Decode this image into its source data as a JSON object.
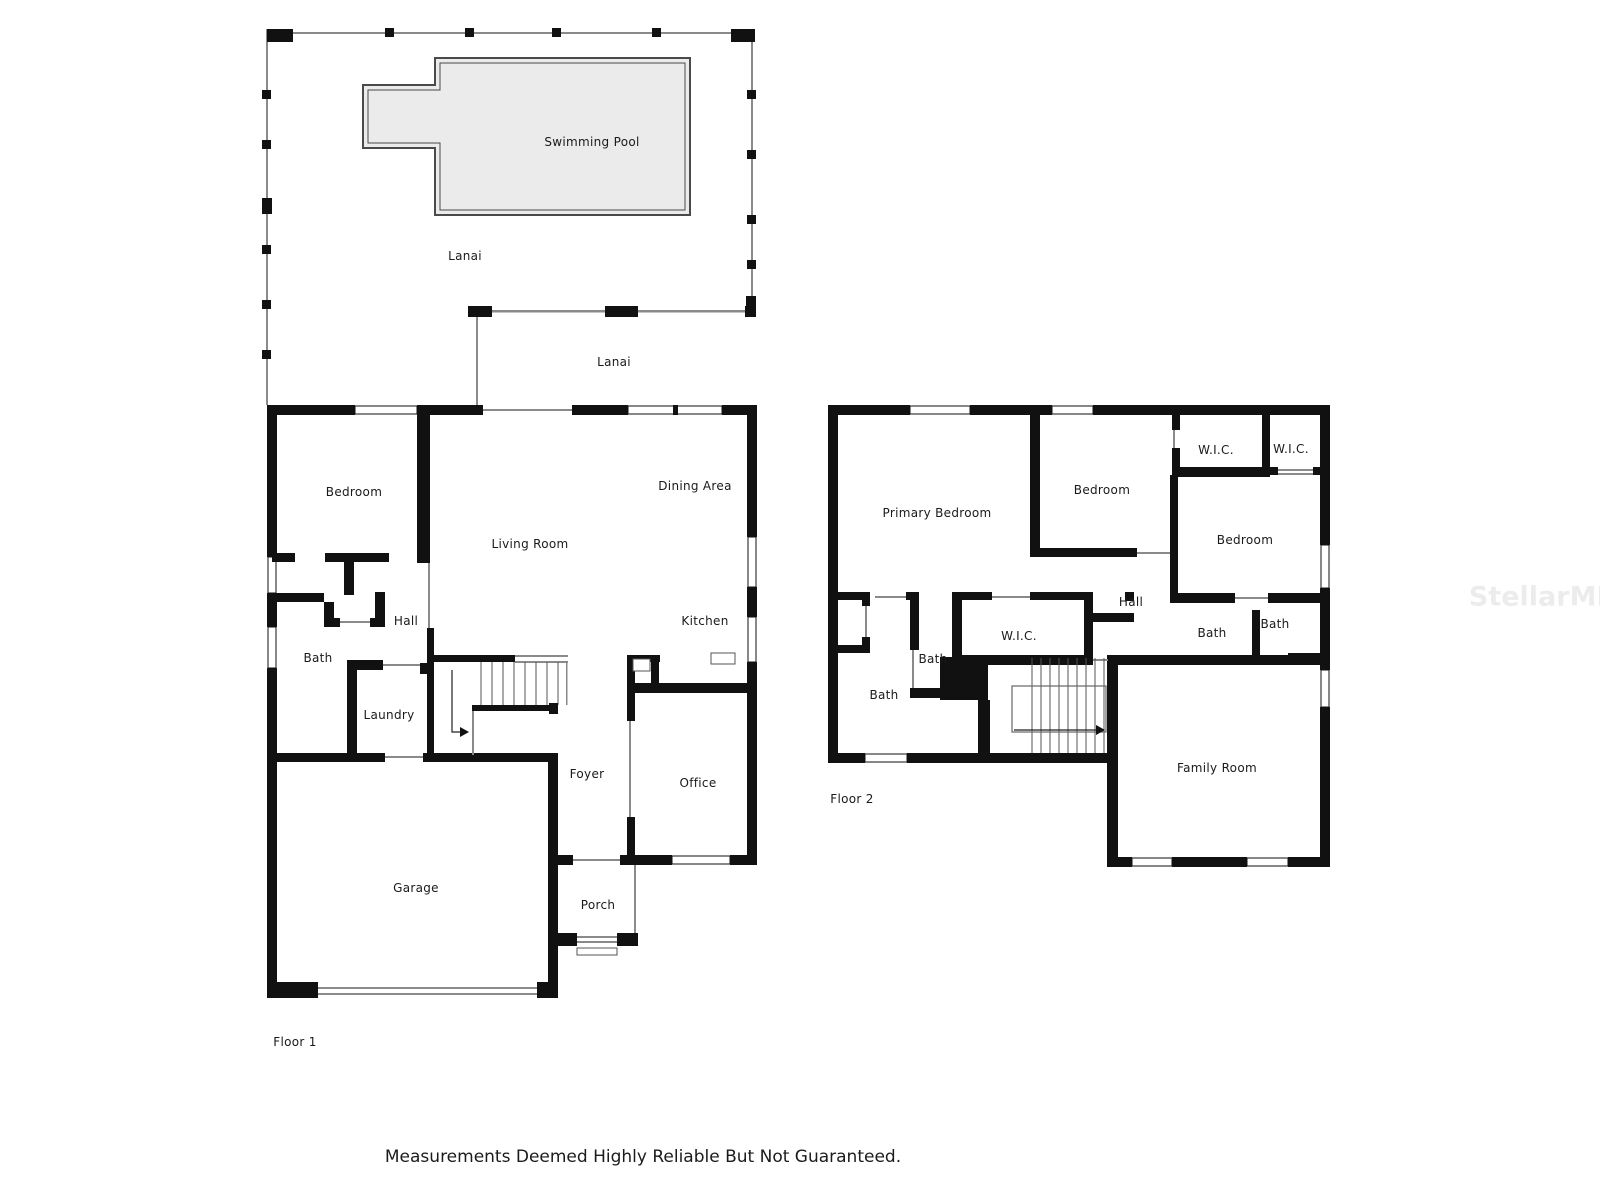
{
  "watermark": {
    "text": "StellarMLS"
  },
  "footer": {
    "disclaimer": "Measurements Deemed Highly Reliable But Not Guaranteed."
  },
  "colors": {
    "wall": "#111111",
    "line": "#8a8a8a",
    "pool_fill": "#ebebeb",
    "pool_line": "#4a4a4a",
    "label_text": "#1a1a1a",
    "watermark_text": "#ececec",
    "footer_text": "#1b1b1b"
  },
  "floor1": {
    "floor_label": "Floor 1",
    "rooms": {
      "swimming_pool": "Swimming Pool",
      "lanai_pool_deck": "Lanai",
      "lanai_covered": "Lanai",
      "bedroom": "Bedroom",
      "living_room": "Living Room",
      "dining_area": "Dining Area",
      "kitchen": "Kitchen",
      "hall": "Hall",
      "bath": "Bath",
      "laundry": "Laundry",
      "foyer": "Foyer",
      "office": "Office",
      "garage": "Garage",
      "porch": "Porch"
    }
  },
  "floor2": {
    "floor_label": "Floor 2",
    "rooms": {
      "primary_bedroom": "Primary Bedroom",
      "bedroom_center": "Bedroom",
      "wic_top_left": "W.I.C.",
      "wic_top_right": "W.I.C.",
      "bedroom_right": "Bedroom",
      "hall": "Hall",
      "wic_center": "W.I.C.",
      "bath_center_small": "Bath",
      "bath_primary": "Bath",
      "bath_right_inner": "Bath",
      "bath_right_outer": "Bath",
      "family_room": "Family Room"
    }
  }
}
